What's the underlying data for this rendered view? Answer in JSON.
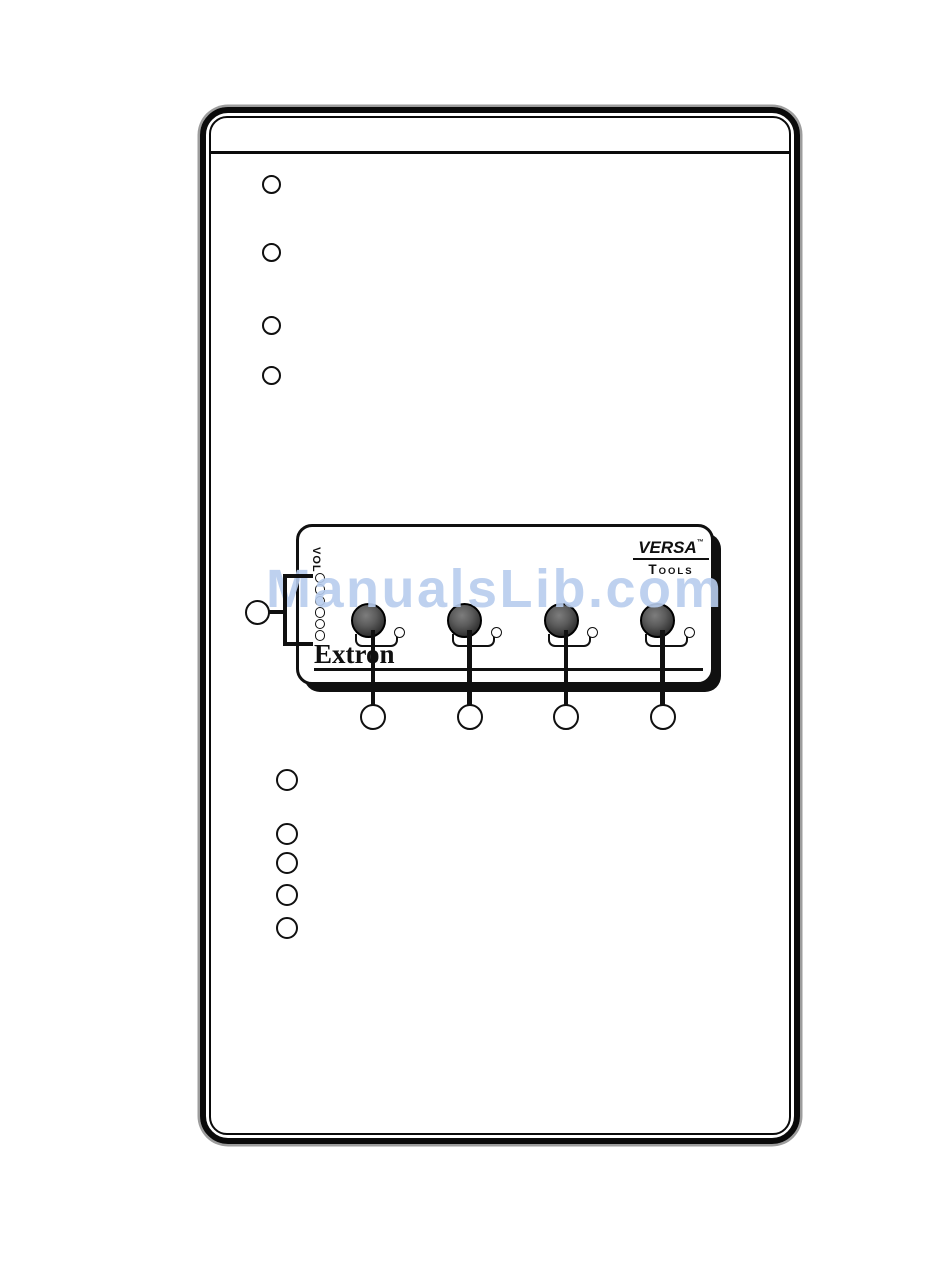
{
  "watermark": {
    "text": "ManualsLib.com",
    "color": "#b8cdee"
  },
  "device_panel": {
    "brand_logo": {
      "versa": "VERSA",
      "trademark": "™",
      "tools_initial": "T",
      "tools_rest": "OOLS"
    },
    "extron_logo": "Extron",
    "volume_label": "VOL",
    "knob_count": 4,
    "knob_led_count": 4,
    "led_column_count": 6
  },
  "callouts": {
    "upper_left_count": 4,
    "left_panel_count": 1,
    "below_panel_count": 4,
    "lower_left_count": 5,
    "label": ""
  },
  "colors": {
    "line_art": "#101010",
    "knob_fill": "#5c5c5c",
    "page_background": "#ffffff",
    "frame_halo": "#9d9d9d"
  }
}
